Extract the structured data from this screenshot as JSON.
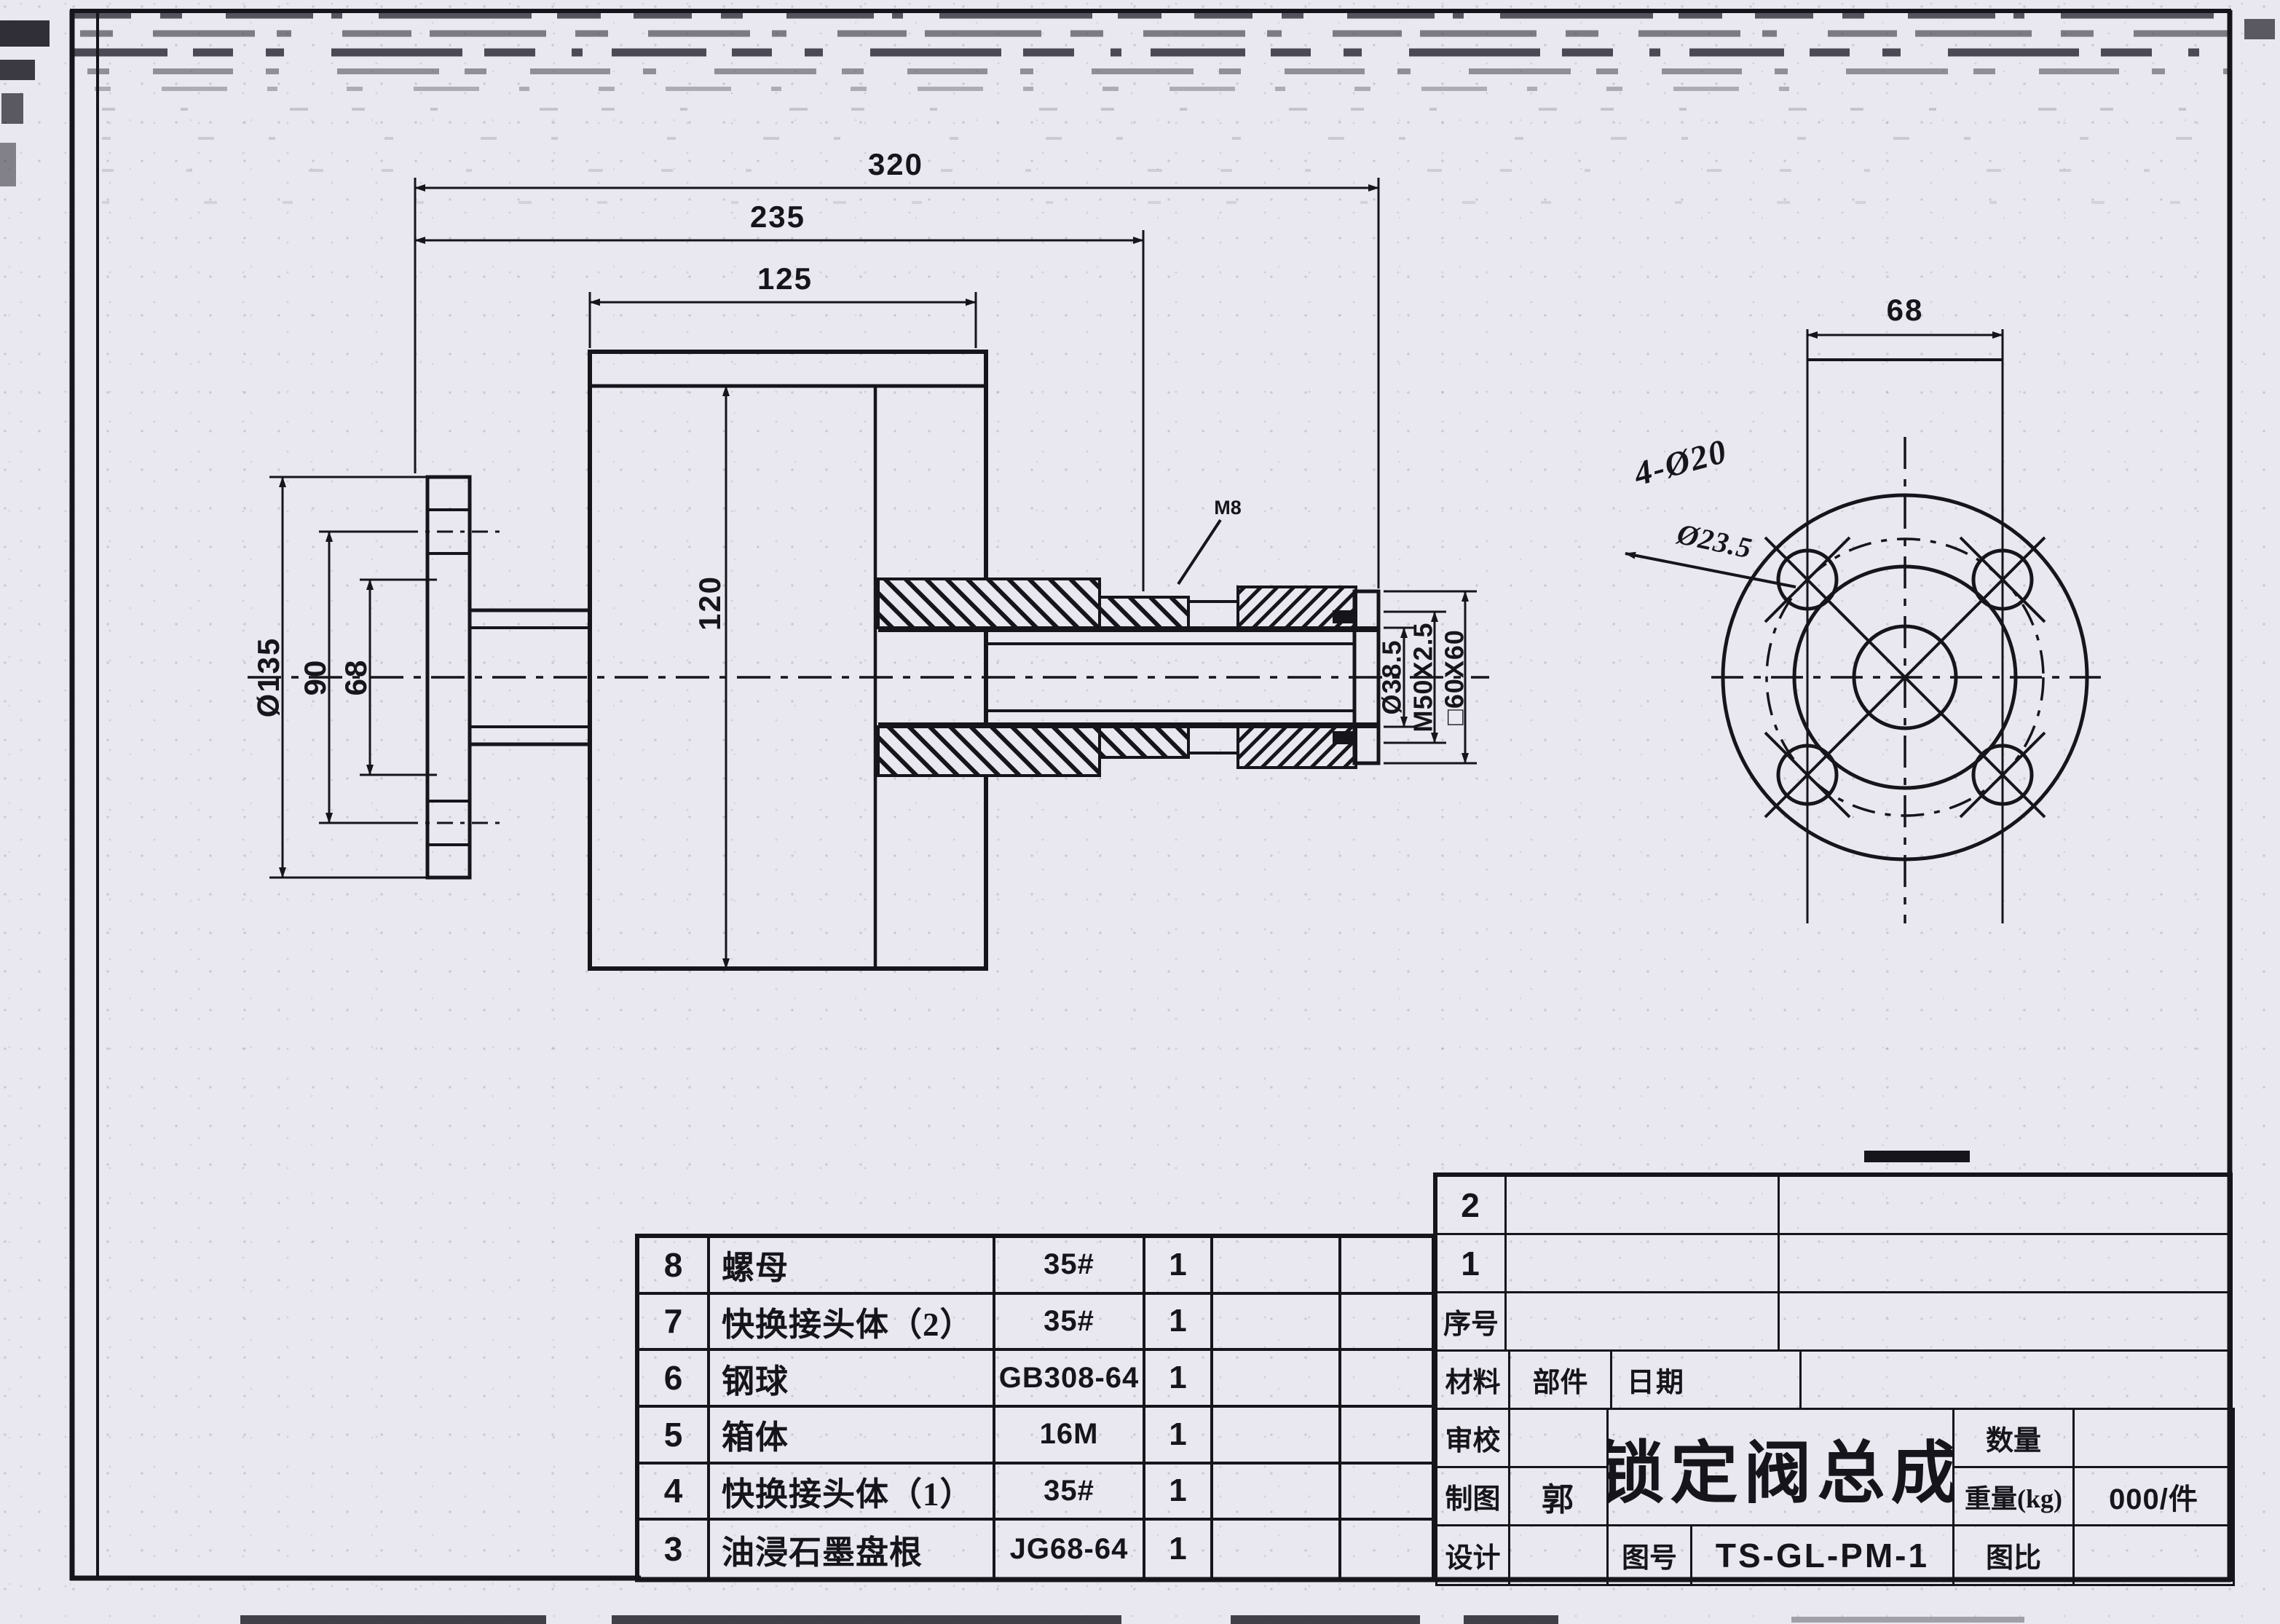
{
  "main_view": {
    "dim_overall": "320",
    "dim_mid": "235",
    "dim_body_width": "125",
    "dim_body_height": "120",
    "dim_flange_od": "Ø135",
    "dim_bolt_circle": "90",
    "dim_hub": "68",
    "label_screw": "M8",
    "dim_bore": "Ø38.5",
    "dim_thread": "M50X2.5",
    "dim_square": "□60X60"
  },
  "end_view": {
    "dim_width": "68",
    "label_holes": "4-Ø20",
    "label_note": "Ø23.5"
  },
  "parts_table": {
    "rows": [
      {
        "no": "8",
        "name": "螺母",
        "spec": "35#",
        "qty": "1"
      },
      {
        "no": "7",
        "name": "快换接头体（2）",
        "spec": "35#",
        "qty": "1"
      },
      {
        "no": "6",
        "name": "钢球",
        "spec": "GB308-64",
        "qty": "1"
      },
      {
        "no": "5",
        "name": "箱体",
        "spec": "16M",
        "qty": "1"
      },
      {
        "no": "4",
        "name": "快换接头体（1）",
        "spec": "35#",
        "qty": "1"
      },
      {
        "no": "3",
        "name": "油浸石墨盘根",
        "spec": "JG68-64",
        "qty": "1"
      }
    ]
  },
  "title_block": {
    "seq_2": "2",
    "seq_1": "1",
    "seq_label": "序号",
    "material_label": "材料",
    "part_label": "部件",
    "date_label": "日期",
    "review_label": "审校",
    "draft_label": "制图",
    "draft_value": "郭",
    "design_label": "设计",
    "title": "锁定阀总成",
    "qty_label": "数量",
    "weight_label": "重量(kg)",
    "weight_value": "000/件",
    "dwg_no_label": "图号",
    "dwg_no_value": "TS-GL-PM-1",
    "scale_label": "图比"
  }
}
